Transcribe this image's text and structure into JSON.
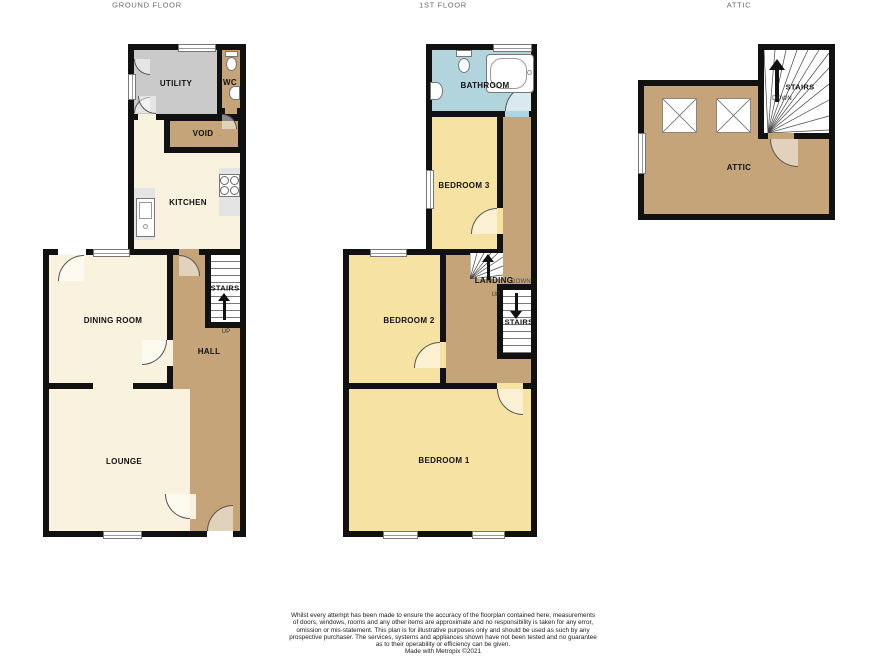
{
  "titles": {
    "ground": "GROUND FLOOR",
    "first": "1ST FLOOR",
    "attic": "ATTIC"
  },
  "ground": {
    "labels": {
      "utility": "UTILITY",
      "wc": "WC",
      "void": "VOID",
      "kitchen": "KITCHEN",
      "dining": "DINING ROOM",
      "stairs": "STAIRS",
      "up": "UP",
      "hall": "HALL",
      "lounge": "LOUNGE"
    }
  },
  "first": {
    "labels": {
      "bathroom": "BATHROOM",
      "bedroom3": "BEDROOM 3",
      "bedroom2": "BEDROOM 2",
      "bedroom1": "BEDROOM 1",
      "landing": "LANDING",
      "down": "DOWN",
      "up": "UP",
      "stairs": "STAIRS"
    }
  },
  "attic": {
    "labels": {
      "attic": "ATTIC",
      "stairs": "STAIRS",
      "down": "DOWN"
    }
  },
  "icons": {
    "fixtures": [
      "toilet-icon",
      "bathtub-icon",
      "sink-icon",
      "kitchen-sink-icon",
      "hob-icon",
      "skylight-icon"
    ],
    "arrows": [
      "up-arrow",
      "down-arrow"
    ]
  },
  "colors": {
    "wall": "#111111",
    "reception_cream": "#F8F2DE",
    "bedroom_yellow": "#F6E3A4",
    "hall_tan": "#C4A478",
    "utility_gray": "#CACACA",
    "bathroom_blue": "#B2D5DD"
  },
  "disclaimer": {
    "lines": [
      "Whilst every attempt has been made to ensure the accuracy of the floorplan contained here, measurements",
      "of doors, windows, rooms and any other items are approximate and no responsibility is taken for any error,",
      "omission or mis-statement. This plan is for illustrative purposes only and should be used as such by any",
      "prospective purchaser. The services, systems and appliances shown have not been tested and no guarantee",
      "as to their operability or efficiency can be given.",
      "Made with Metropix ©2021"
    ]
  }
}
